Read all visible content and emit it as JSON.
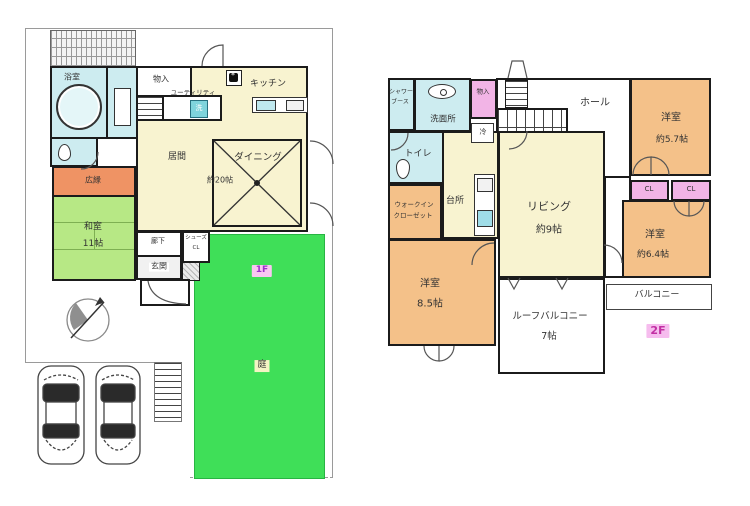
{
  "floor1": {
    "badge": "1F",
    "rooms": {
      "bathroom": "浴室",
      "storage": "物入",
      "utility": "ユーティリティ",
      "washer": "洗",
      "kitchen": "キッチン",
      "living": "居間",
      "living_size": "約20帖",
      "dining": "ダイニング",
      "hiroen": "広縁",
      "washitsu": "和室",
      "washitsu_size": "11帖",
      "corridor": "廊下",
      "shoes_line1": "シューズ",
      "shoes_line2": "CL",
      "entrance": "玄関",
      "garden": "庭"
    }
  },
  "floor2": {
    "badge": "2F",
    "rooms": {
      "shower_line1": "シャワー",
      "shower_line2": "ブース",
      "washroom": "洗面所",
      "storage": "物入",
      "fridge": "冷",
      "hall": "ホール",
      "bedroom1": "洋室",
      "bedroom1_size": "約5.7帖",
      "toilet": "トイレ",
      "wic_line1": "ウォークイン",
      "wic_line2": "クローゼット",
      "kitchen": "台所",
      "living": "リビング",
      "living_size": "約9帖",
      "closet1": "CL",
      "closet2": "CL",
      "bedroom2": "洋室",
      "bedroom2_size": "約6.4帖",
      "bedroom3": "洋室",
      "bedroom3_size": "8.5帖",
      "roof_balcony": "ルーフバルコニー",
      "roof_balcony_size": "7帖",
      "balcony": "バルコニー"
    }
  },
  "colors": {
    "wall": "#1b1b1b",
    "ldk_yellow": "#f8f3d0",
    "wet_cyan": "#cdecf0",
    "hiroen_orange": "#ef9364",
    "washitsu_green": "#b7e885",
    "garden_green": "#3fdf58",
    "bedroom_orange": "#f4c189",
    "closet_pink": "#f2b4e6",
    "badge_pink": "#f9c7f2"
  }
}
